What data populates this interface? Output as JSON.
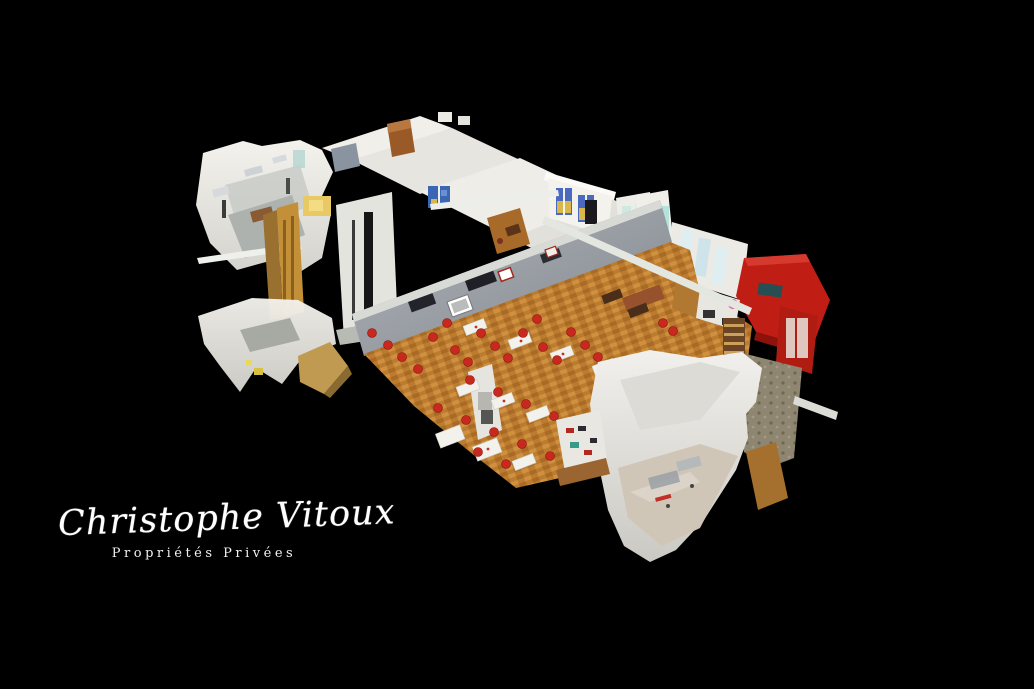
{
  "page": {
    "width": 1034,
    "height": 689,
    "background": "#000000"
  },
  "watermark": {
    "name": "Christophe Vitoux",
    "subtitle": "Propriétés Privées",
    "text_color": "#ffffff"
  },
  "scene": {
    "type": "3d-dollhouse-cutaway-view",
    "subject": "restaurant interior 3D scan seen from above at an angle",
    "colors": {
      "background": "#000000",
      "walls_white": "#ece9e3",
      "divider_wall_gray": "#9ba0a8",
      "floor_parquet": "#c08034",
      "annex_floor_beige": "#cfc6b8",
      "chair_red": "#c8281e",
      "bar_wall_red": "#c01e14",
      "wine_rack_wood": "#6b4423",
      "window_blue": "#3a66b4",
      "window_teal": "#aee0d8",
      "window_yellow": "#d9b84a",
      "cabinet_gold": "#c39038",
      "stone_gray": "#8f8672",
      "accent_pink": "#d860a8"
    }
  }
}
